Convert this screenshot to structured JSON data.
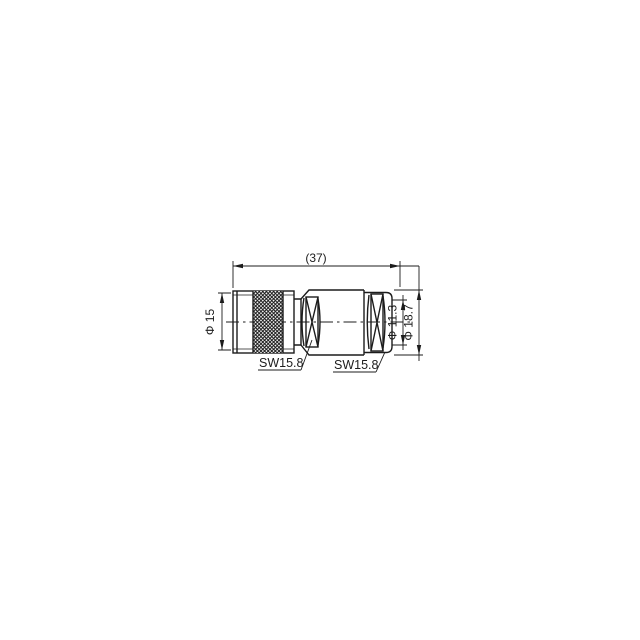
{
  "page": {
    "background": "#ffffff"
  },
  "drawing": {
    "kind": "engineering-dimension-drawing",
    "subject": "coaxial connector side elevation",
    "line_color": "#1c1c1c",
    "dimensions": {
      "overall_length": "(37)",
      "coupling_nut_diameter": "Φ 15",
      "cable_entry_diameter": "Φ 11.3",
      "rear_body_diameter": "Φ 18.7"
    },
    "labels": {
      "front_wrench_size": "SW15.8",
      "rear_wrench_size": "SW15.8"
    }
  }
}
